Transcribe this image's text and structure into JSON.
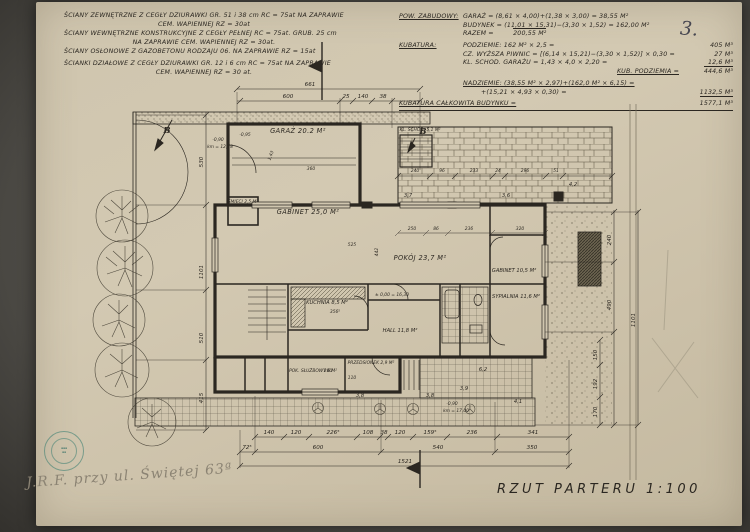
{
  "sheet": {
    "page_number": "3.",
    "title": "RZUT PARTERU 1:100",
    "handwriting": "J.R.F.  przy ul. Świętej  63ª"
  },
  "notes": {
    "lines": [
      "ŚCIANY ZEWNĘTRZNE Z CEGŁY DZIURAWKI GR. 51 i 38 cm RC = 75at NA ZAPRAWIE",
      "CEM. WAPIENNEJ RZ = 30at",
      "ŚCIANY WEWNĘTRZNE KONSTRUKCYJNE Z CEGŁY PEŁNEJ RC = 75at. GRUB. 25 cm",
      "NA ZAPRAWIE CEM. WAPIENNEJ RZ = 30at.",
      "ŚCIANY OSŁONOWE Z GAZOBETONU RODZAJU 06. NA ZAPRAWIE RZ = 15at",
      "ŚCIANKI DZIAŁOWE Z CEGŁY DZIURAWKI GR. 12 i 6 cm RC = 75at NA ZAPRAWIE",
      "CEM. WAPIENNEJ RZ = 30 at."
    ]
  },
  "calculations": {
    "pow_zabudowy_label": "POW. ZABUDOWY:",
    "garaz_line": "GARAŻ = (8,61 × 4,00)+(1,38 × 3,00) = 38,55 M²",
    "budynek_line": "BUDYNEK = (11,01 × 15,31)−(3,30 × 1,52) = 162,00 M²",
    "razem_label": "RAZEM =",
    "razem_value": "200,55 M²",
    "kubatura_label": "KUBATURA:",
    "podziemie_line": "PODZIEMIE:  162 M² × 2,5 =",
    "podziemie_value": "405 M³",
    "piwnice_line": "CZ. WYŻSZA PIWNIC = [(6,14 × 15,21)−(3,30 × 1,52)] × 0,30 =",
    "piwnice_value": "27 M³",
    "schody_line": "KL. SCHOD. GARAŻU = 1,43 × 4,0 × 2,20 =",
    "schody_value": "12,6 M³",
    "kub_podziemia_label": "KUB. PODZIEMIA =",
    "kub_podziemia_value": "444,6 M³",
    "nadziemie_line1": "NADZIEMIE: (38,55 M² × 2,97)+(162,0 M² × 6,15) =",
    "nadziemie_line2": "+(15,21 × 4,93 × 0,30) =",
    "nadziemie_value": "1132,5 M³",
    "total_label": "KUBATURA CAŁKOWITA BUDYNKU =",
    "total_value": "1577,1 M³"
  },
  "rooms": {
    "garaz": "GARAŻ 20.2 M²",
    "smieci": "ŚMIECI 2,5 M²",
    "gabinet1": "GABINET 25,0 M²",
    "pokoj": "POKÓJ 23,7 M²",
    "gabinet2": "GABINET 10,5 M²",
    "sypialnia": "SYPIALNIA 11,6 M²",
    "kuchnia": "KUCHNIA 8,5 M²",
    "hall": "HALL 11,8 M²",
    "przedsionek": "PRZEDSIONEK 2,9 M²",
    "pok_sluzbowy": "POK. SŁUŻBOWY 6 M²",
    "kl_schod": "KL. SCHOD. 5,1 M²"
  },
  "dims": {
    "top_total": "661",
    "top": [
      "600",
      "25",
      "140",
      "38"
    ],
    "bottom1": [
      "140",
      "120",
      "226⁵",
      "108",
      "38",
      "120",
      "159⁵",
      "236",
      "341"
    ],
    "bottom2": [
      "72⁵",
      "600",
      "540",
      "350"
    ],
    "bottom_total": "1521",
    "left": [
      "530",
      "1101",
      "510",
      "415"
    ],
    "right": [
      "240",
      "490",
      "1101"
    ],
    "right_lower": [
      "150",
      "192",
      "170"
    ],
    "terrace": [
      "240",
      "96",
      "233",
      "24",
      "296",
      "51"
    ],
    "interior": [
      "250",
      "86",
      "236",
      "320",
      "442",
      "525",
      "356⁵",
      "360",
      "280",
      "110",
      "1,43"
    ]
  },
  "levels": {
    "l1": "-0,90",
    "l1b": "km = 12,78",
    "l2": "-0,95",
    "l3": "± 0,00 = 16,30",
    "l4": "-0,90",
    "l4b": "km = 17,00"
  },
  "spots": [
    "3,7",
    "3,6",
    "4,2",
    "6,2",
    "3,9",
    "4,1",
    "3,8",
    "3,8"
  ],
  "markers": {
    "b1": "B",
    "b2": "B"
  }
}
